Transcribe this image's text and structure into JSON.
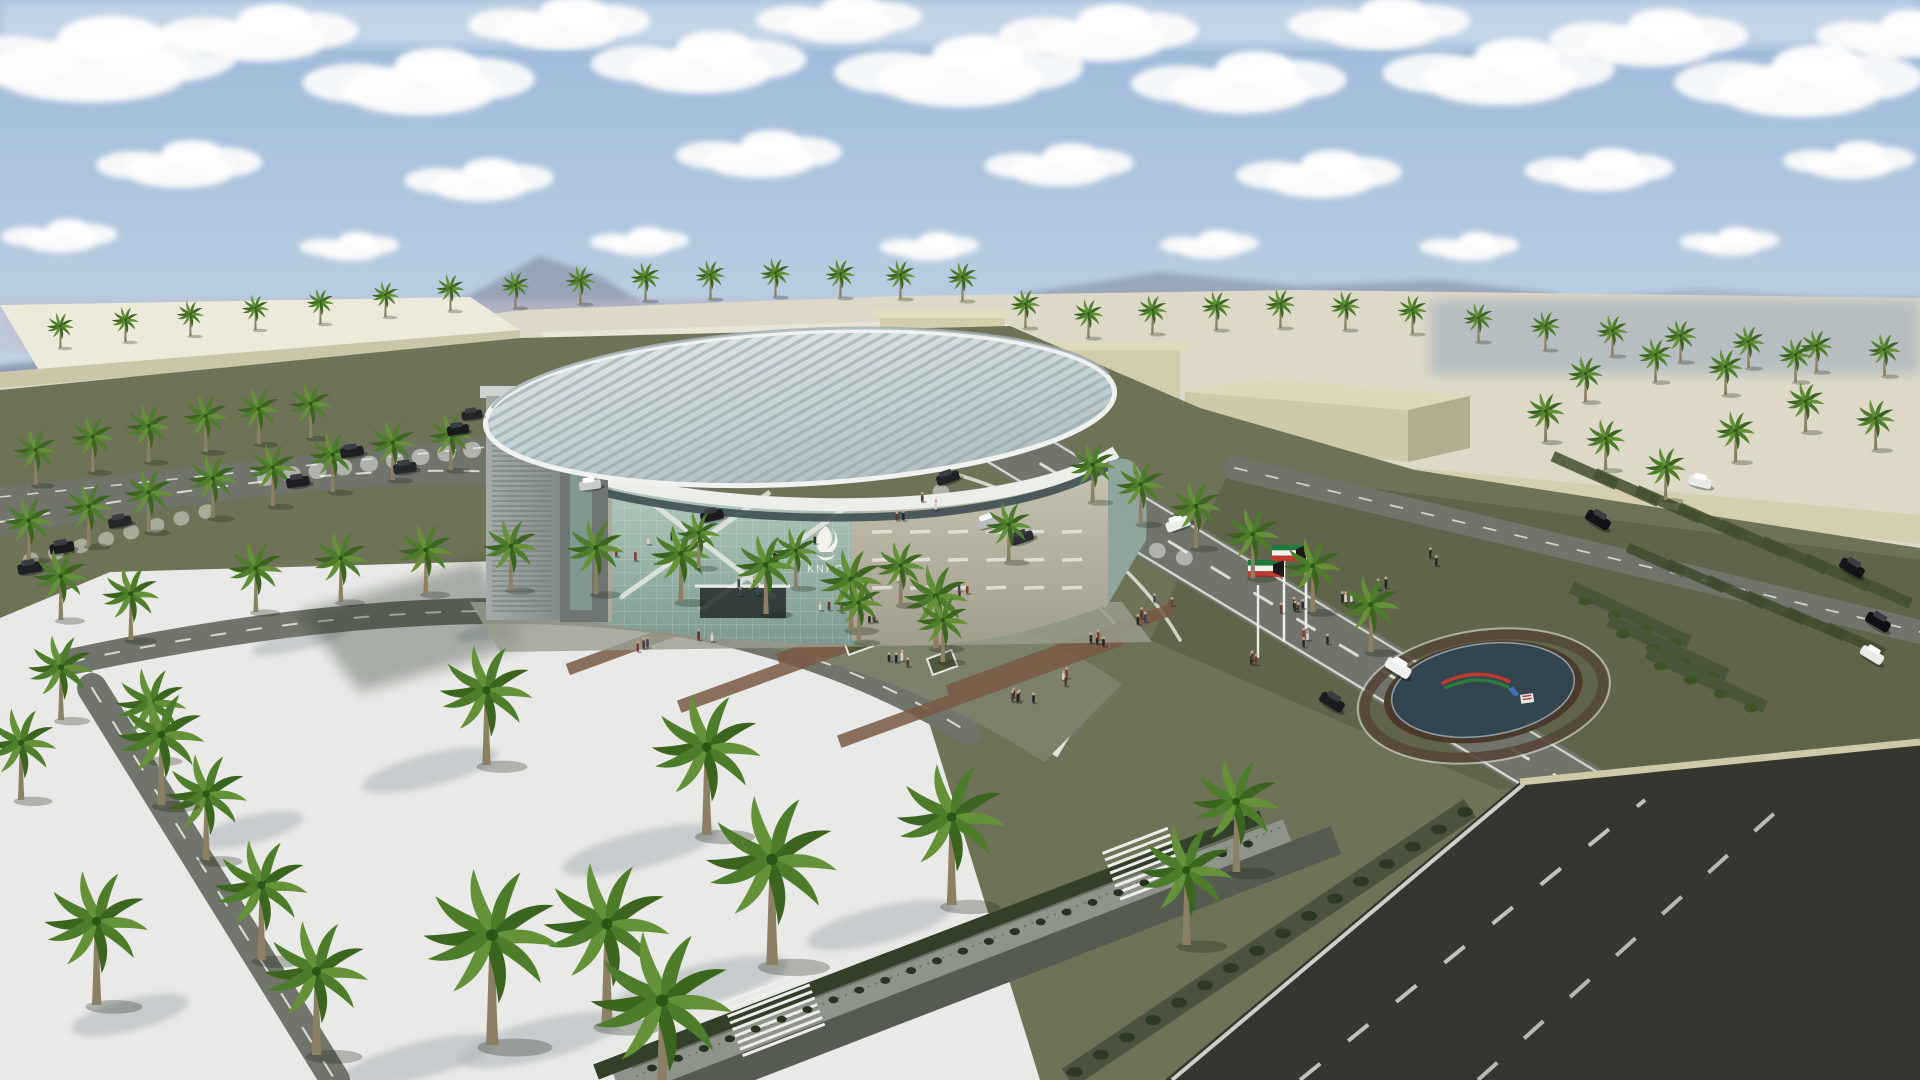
{
  "scene": {
    "kind": "aerial-architectural-rendering",
    "subject": "KNPC elliptical glass building in desert campus with palm trees, parking, flags and highway"
  },
  "branding": {
    "logo_text": "KNPC",
    "logo_icon": "flame-icon",
    "logo_color": "#f2f1ea"
  },
  "flags": {
    "country": "Kuwait",
    "count": 2,
    "colors": {
      "green": "#1e7a3c",
      "white": "#f2f2ee",
      "red": "#bf392e",
      "black": "#1a1a1a"
    }
  },
  "monument": {
    "icon": "knpc-swoosh-logo",
    "disc_color": "#33454f",
    "swoosh_red": "#c23a30",
    "swoosh_green": "#2e7d3a",
    "mark_blue": "#3f6fb5"
  },
  "palette": {
    "sky_top": "#9cb9da",
    "sky_horizon": "#ccd9e6",
    "haze": "#c3b8c4",
    "mountain": "#93a0b6",
    "sand": "#ddd8c8",
    "sand_bright": "#edeadc",
    "wall_beige": "#d6cfae",
    "lawn": "#6e7257",
    "lawn_dark": "#55593f",
    "road": "#70746a",
    "asphalt": "#34362f",
    "plaza": "#7d816c",
    "paver": "#7a5a45",
    "white_lot": "#e9e9e7",
    "glass": "#a9bfb2",
    "stone": "#b5b3a4",
    "roof": "#ccd7d9",
    "palm_green": "#4d7c2a",
    "trunk": "#8d7f63"
  }
}
